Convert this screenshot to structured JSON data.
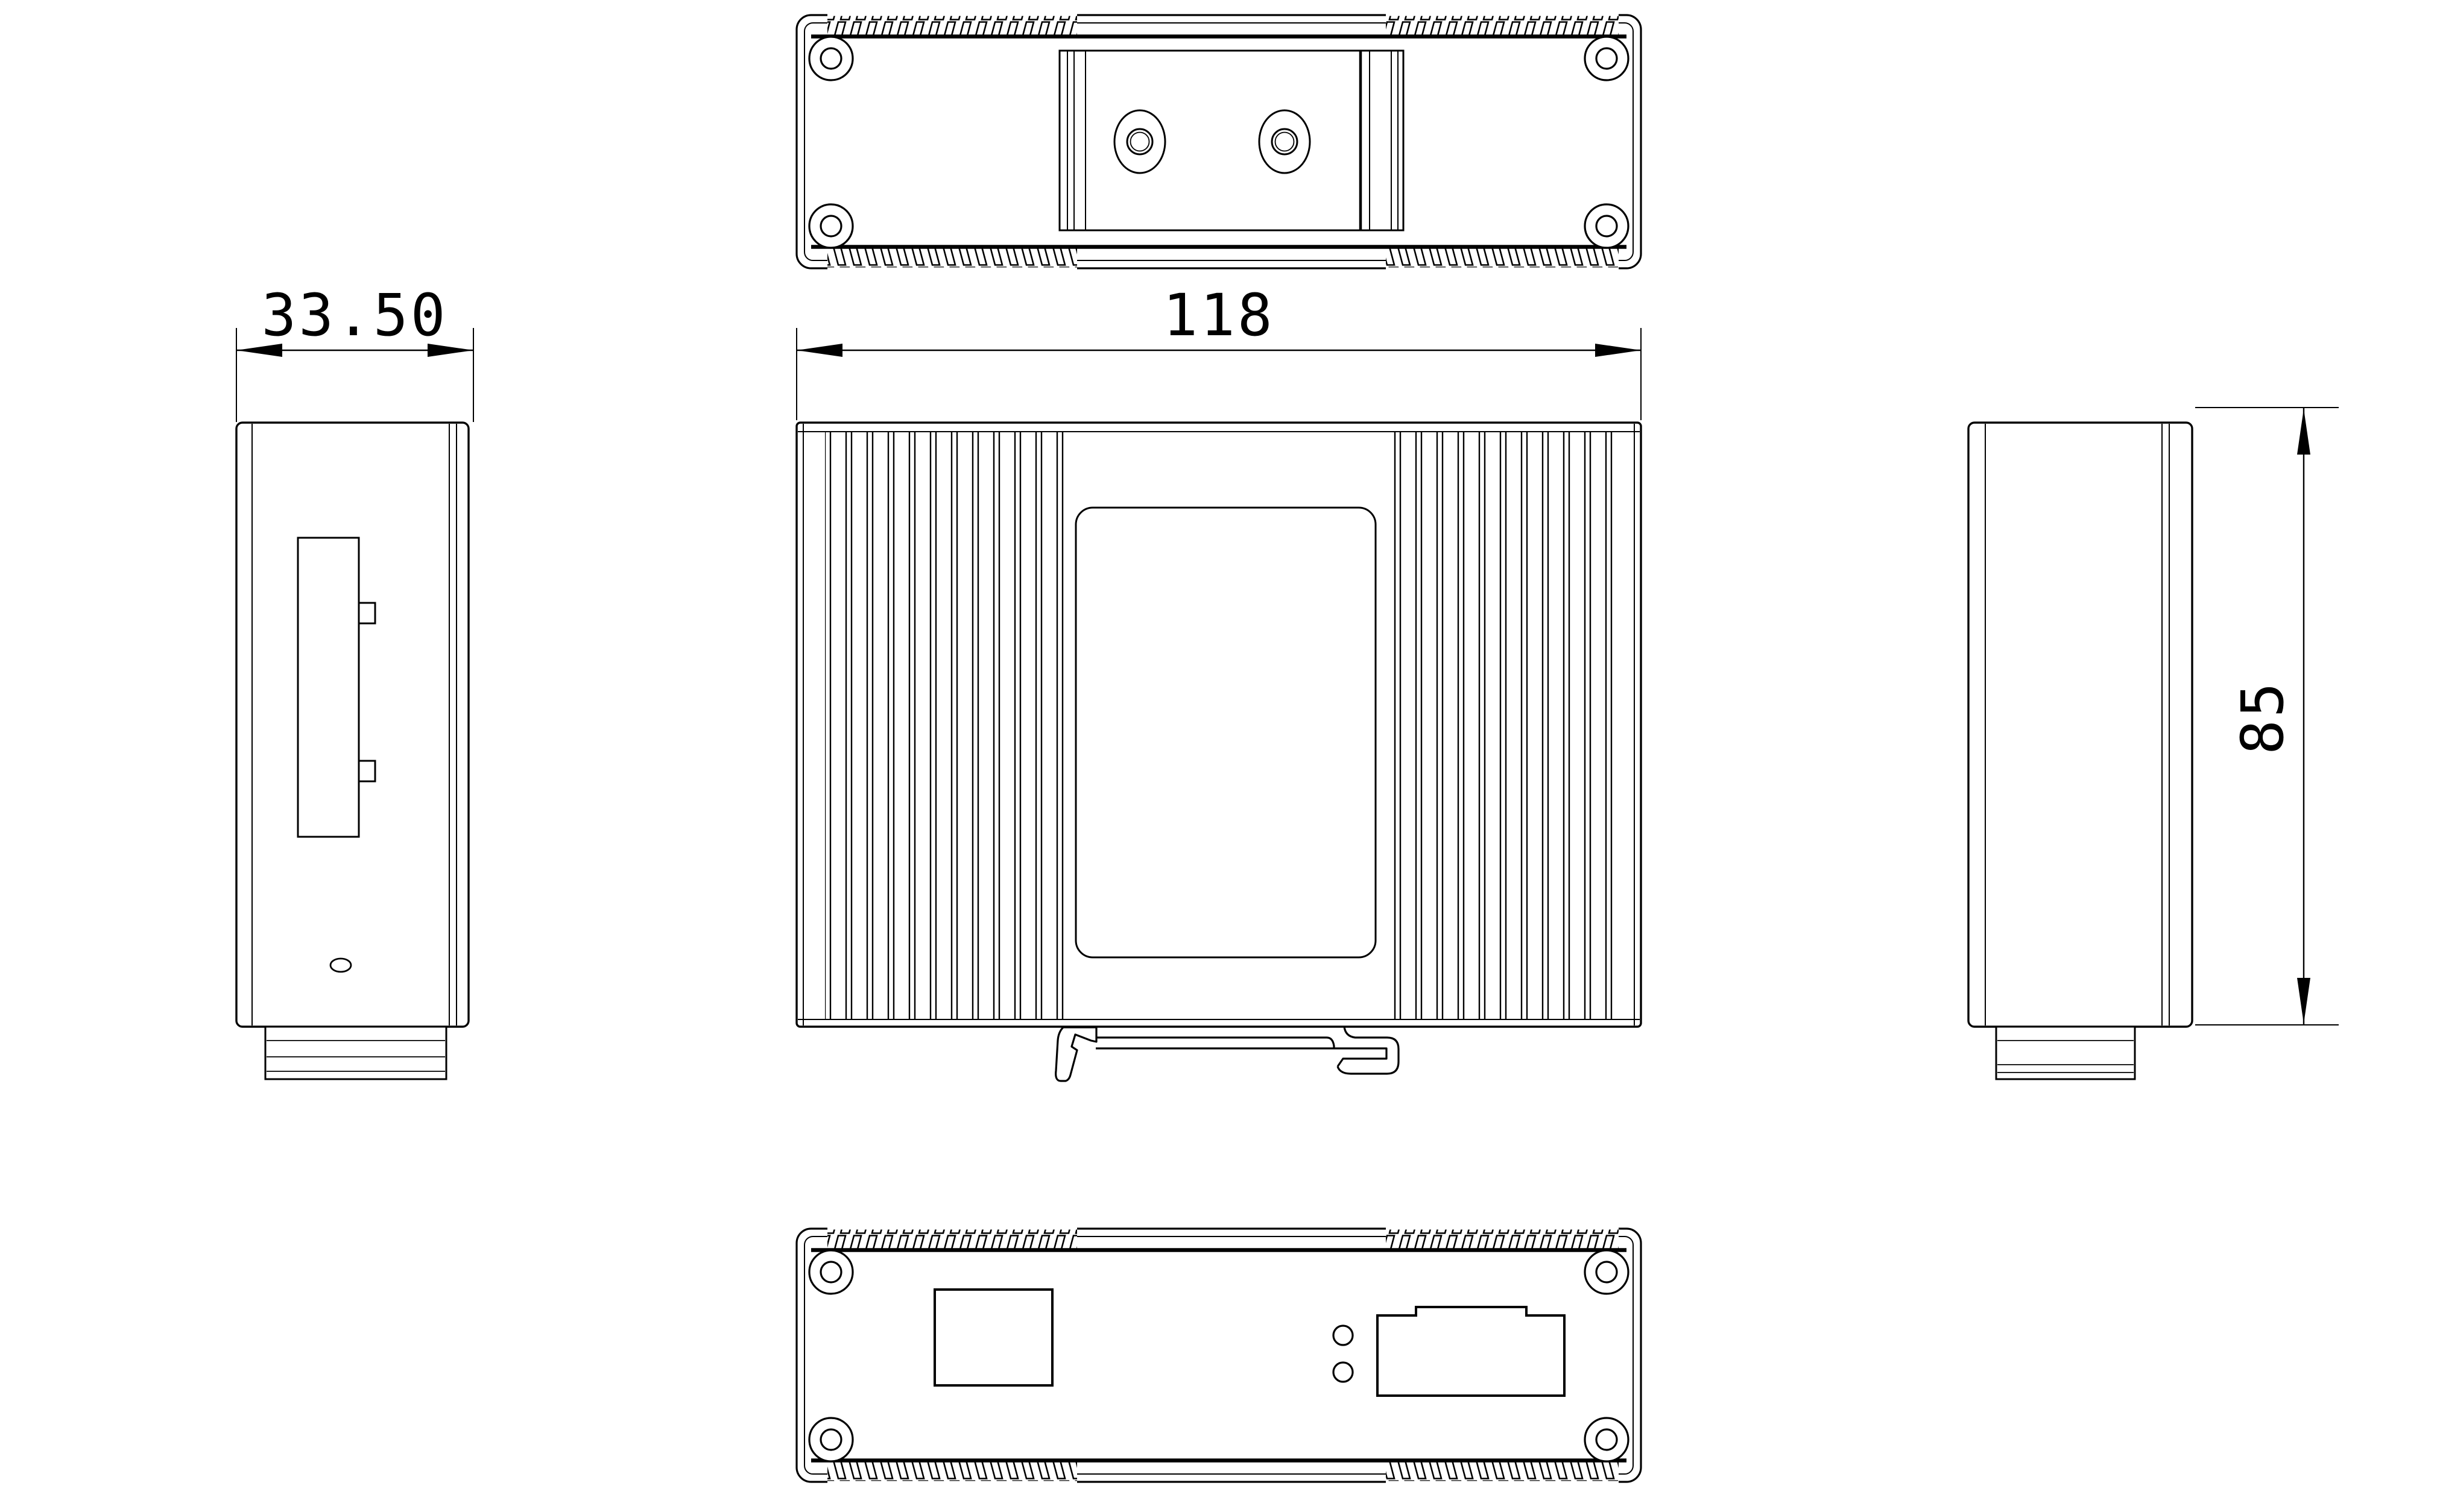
{
  "document": {
    "type": "mechanical-engineering-drawing",
    "subject": "din-rail-enclosure-orthographic-views",
    "colors": {
      "background": "#ffffff",
      "line": "#000000"
    }
  },
  "dimensions": {
    "left_view_width": "33.50",
    "front_view_width": "118",
    "side_view_height": "85"
  }
}
